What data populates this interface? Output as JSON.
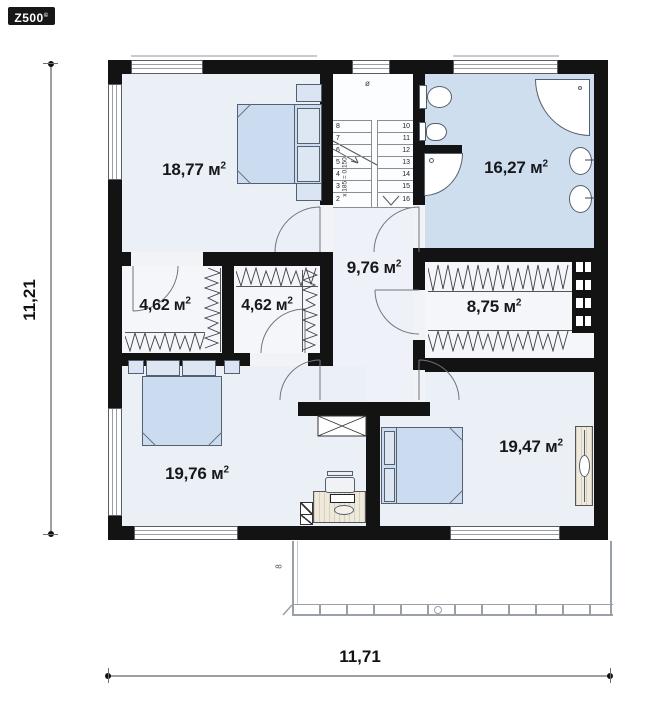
{
  "logo": {
    "brand": "Z500",
    "copyright": "©"
  },
  "dimensions": {
    "vertical_total": "11,21",
    "horizontal_total": "11,71"
  },
  "rooms": [
    {
      "name": "bedroom-top-left",
      "area": "18,77 м",
      "sup": "2"
    },
    {
      "name": "bathroom",
      "area": "16,27 м",
      "sup": "2"
    },
    {
      "name": "hall-staircase",
      "area": "9,76 м",
      "sup": "2"
    },
    {
      "name": "wardrobe-left",
      "area": "4,62 м",
      "sup": "2"
    },
    {
      "name": "wardrobe-middle",
      "area": "4,62 м",
      "sup": "2"
    },
    {
      "name": "wardrobe-right",
      "area": "8,75 м",
      "sup": "2"
    },
    {
      "name": "bedroom-bottom-left",
      "area": "19,76 м",
      "sup": "2"
    },
    {
      "name": "bedroom-bottom-right",
      "area": "19,47 м",
      "sup": "2"
    }
  ],
  "stairs": {
    "left_flight": [
      "8",
      "7",
      "6",
      "5",
      "4",
      "3",
      "2"
    ],
    "right_flight": [
      "10",
      "11",
      "12",
      "13",
      "14",
      "15",
      "16"
    ],
    "riser_note": "x 185 = 0,150",
    "landing_mark": "ø"
  },
  "balcony": {
    "mark": "8"
  },
  "colors": {
    "wall": "#131313",
    "room_fill": "#ebeff6",
    "wet_room_fill": "#cfdeee",
    "furniture_fill": "#ccdcf0",
    "outline": "#555555"
  }
}
